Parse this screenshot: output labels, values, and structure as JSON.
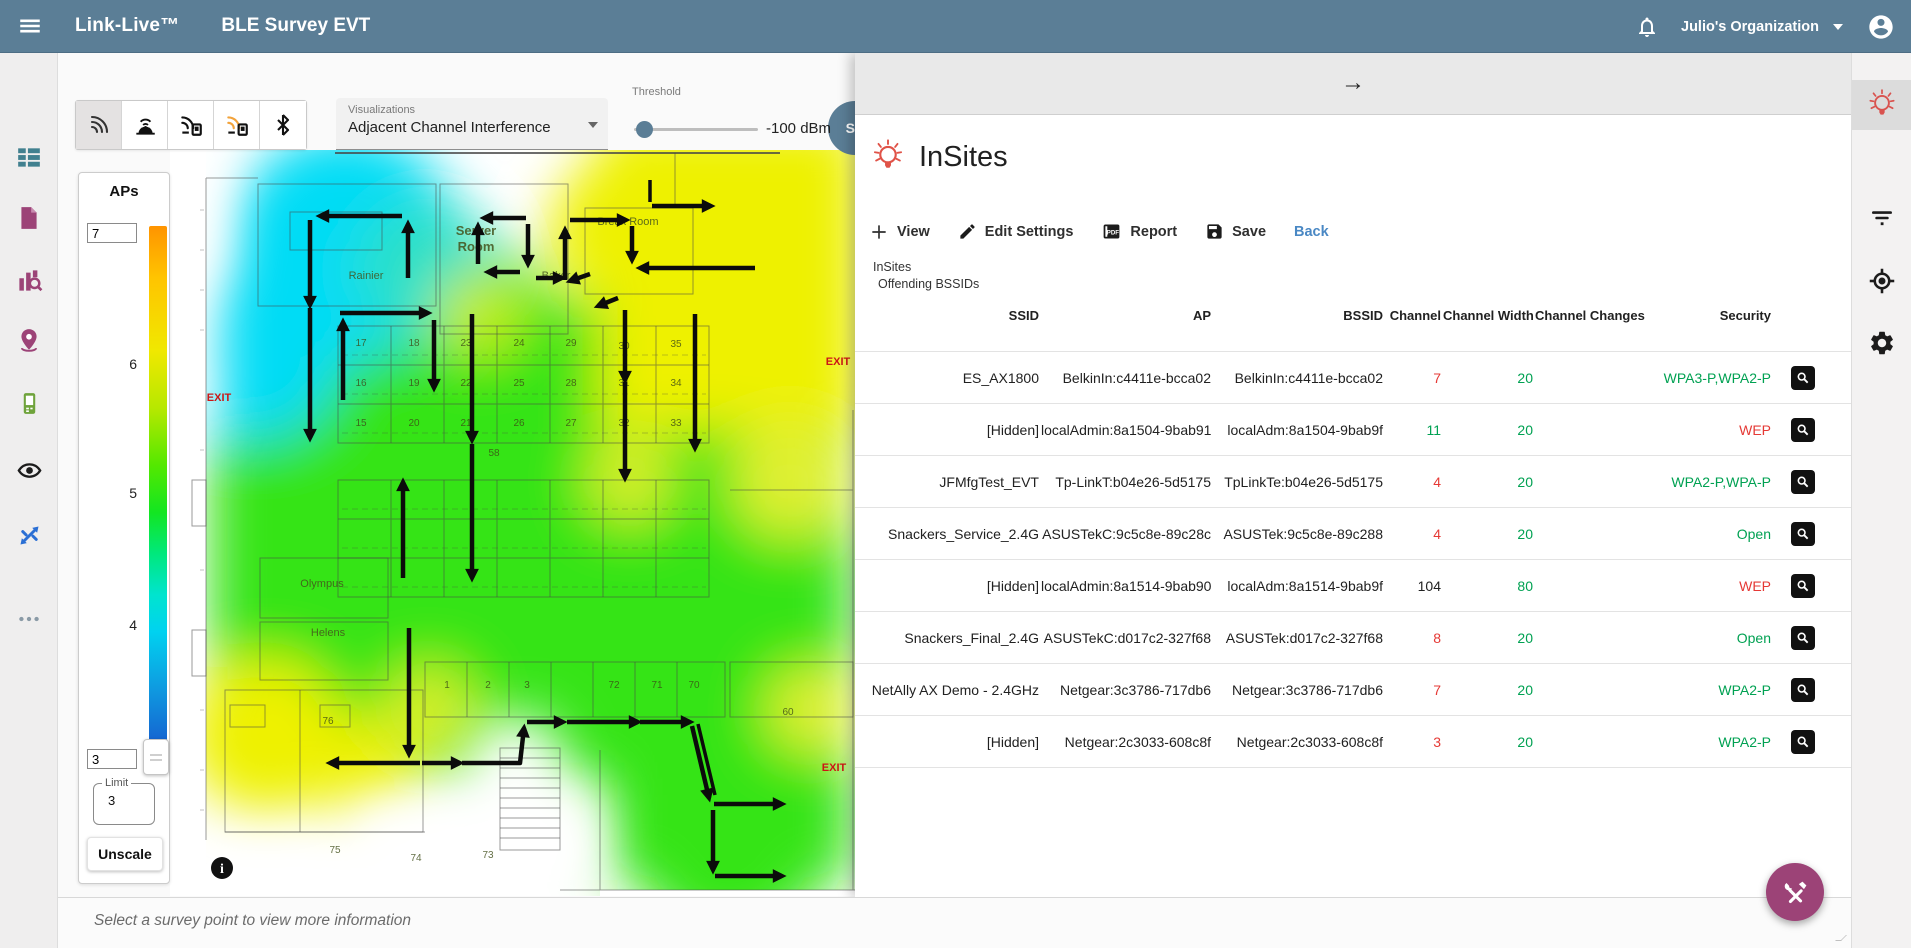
{
  "topbar": {
    "brand": "Link-Live™",
    "app_title": "BLE Survey EVT",
    "organization": "Julio's Organization",
    "icons": [
      "menu-icon",
      "notifications-bell-icon",
      "caret-down-icon",
      "account-circle-icon"
    ]
  },
  "left_rail": {
    "icons": [
      "dashboard-list-icon",
      "document-icon",
      "analysis-icon",
      "sites-pin-icon",
      "tester-device-icon",
      "discovery-eye-icon",
      "autotest-arrows-icon",
      "more-dots-icon"
    ]
  },
  "right_rail": {
    "icons": [
      "insites-bulb-icon",
      "filter-icon",
      "locate-icon",
      "settings-gear-icon"
    ],
    "active": "insites-bulb-icon"
  },
  "toolbar": {
    "mode_buttons": [
      "signal-icon",
      "access-point-icon",
      "signal-device-icon",
      "interference-device-icon",
      "bluetooth-icon"
    ],
    "selected_mode": "signal-icon",
    "visualizations_label": "Visualizations",
    "visualization_value": "Adjacent Channel Interference",
    "threshold_label": "Threshold",
    "threshold_value": "-100 dBm",
    "ssid_badge": "SS"
  },
  "aps_panel": {
    "title": "APs",
    "max_value": "7",
    "scale_labels": [
      "6",
      "5",
      "4"
    ],
    "min_value": "3",
    "limit_label": "Limit",
    "limit_value": "3",
    "unscale_button": "Unscale"
  },
  "map": {
    "labels": [
      {
        "text": "Server",
        "x": 306,
        "y": 85,
        "cls": "room"
      },
      {
        "text": "Room",
        "x": 306,
        "y": 101,
        "cls": "room"
      },
      {
        "text": "Rainier",
        "x": 196,
        "y": 129,
        "cls": "room-sm"
      },
      {
        "text": "Baker",
        "x": 386,
        "y": 129,
        "cls": "room-sm"
      },
      {
        "text": "Break Room",
        "x": 458,
        "y": 75,
        "cls": "room-sm"
      },
      {
        "text": "Olympus",
        "x": 152,
        "y": 437,
        "cls": "room-sm"
      },
      {
        "text": "Helens",
        "x": 158,
        "y": 486,
        "cls": "room-sm"
      },
      {
        "text": "EXIT",
        "x": 49,
        "y": 251,
        "cls": "exit"
      },
      {
        "text": "EXIT",
        "x": 668,
        "y": 215,
        "cls": "exit"
      },
      {
        "text": "EXIT",
        "x": 664,
        "y": 621,
        "cls": "exit"
      },
      {
        "text": "17",
        "x": 191,
        "y": 196,
        "cls": "num"
      },
      {
        "text": "18",
        "x": 244,
        "y": 196,
        "cls": "num"
      },
      {
        "text": "23",
        "x": 296,
        "y": 196,
        "cls": "num"
      },
      {
        "text": "24",
        "x": 349,
        "y": 196,
        "cls": "num"
      },
      {
        "text": "29",
        "x": 401,
        "y": 196,
        "cls": "num"
      },
      {
        "text": "30",
        "x": 454,
        "y": 199,
        "cls": "num"
      },
      {
        "text": "35",
        "x": 506,
        "y": 197,
        "cls": "num"
      },
      {
        "text": "16",
        "x": 191,
        "y": 236,
        "cls": "num"
      },
      {
        "text": "19",
        "x": 244,
        "y": 236,
        "cls": "num"
      },
      {
        "text": "22",
        "x": 296,
        "y": 236,
        "cls": "num"
      },
      {
        "text": "25",
        "x": 349,
        "y": 236,
        "cls": "num"
      },
      {
        "text": "28",
        "x": 401,
        "y": 236,
        "cls": "num"
      },
      {
        "text": "31",
        "x": 454,
        "y": 236,
        "cls": "num"
      },
      {
        "text": "34",
        "x": 506,
        "y": 236,
        "cls": "num"
      },
      {
        "text": "15",
        "x": 191,
        "y": 276,
        "cls": "num"
      },
      {
        "text": "20",
        "x": 244,
        "y": 276,
        "cls": "num"
      },
      {
        "text": "21",
        "x": 296,
        "y": 276,
        "cls": "num"
      },
      {
        "text": "26",
        "x": 349,
        "y": 276,
        "cls": "num"
      },
      {
        "text": "27",
        "x": 401,
        "y": 276,
        "cls": "num"
      },
      {
        "text": "32",
        "x": 454,
        "y": 276,
        "cls": "num"
      },
      {
        "text": "33",
        "x": 506,
        "y": 276,
        "cls": "num"
      },
      {
        "text": "58",
        "x": 324,
        "y": 306,
        "cls": "num"
      },
      {
        "text": "76",
        "x": 158,
        "y": 574,
        "cls": "num"
      },
      {
        "text": "75",
        "x": 165,
        "y": 703,
        "cls": "num"
      },
      {
        "text": "74",
        "x": 246,
        "y": 711,
        "cls": "num"
      },
      {
        "text": "73",
        "x": 318,
        "y": 708,
        "cls": "num"
      },
      {
        "text": "1",
        "x": 277,
        "y": 538,
        "cls": "num"
      },
      {
        "text": "2",
        "x": 318,
        "y": 538,
        "cls": "num"
      },
      {
        "text": "3",
        "x": 357,
        "y": 538,
        "cls": "num"
      },
      {
        "text": "72",
        "x": 444,
        "y": 538,
        "cls": "num"
      },
      {
        "text": "71",
        "x": 487,
        "y": 538,
        "cls": "num"
      },
      {
        "text": "70",
        "x": 524,
        "y": 538,
        "cls": "num"
      },
      {
        "text": "60",
        "x": 618,
        "y": 565,
        "cls": "num"
      }
    ],
    "info_icon": "i"
  },
  "insites": {
    "collapse_arrow": "→",
    "title": "InSites",
    "actions": [
      {
        "icon": "plus-icon",
        "label": "View"
      },
      {
        "icon": "pencil-icon",
        "label": "Edit Settings"
      },
      {
        "icon": "pdf-report-icon",
        "label": "Report"
      },
      {
        "icon": "save-icon",
        "label": "Save"
      }
    ],
    "back_label": "Back",
    "breadcrumb": [
      "InSites",
      "Offending BSSIDs"
    ],
    "table": {
      "columns": [
        "SSID",
        "AP",
        "BSSID",
        "Channel",
        "Channel Width",
        "Channel Changes",
        "Security"
      ],
      "rows": [
        {
          "ssid": "ES_AX1800",
          "ap": "BelkinIn:c4411e-bcca02",
          "bssid": "BelkinIn:c4411e-bcca02",
          "channel": "7",
          "channel_color": "t-red",
          "channel_width": "20",
          "width_color": "t-green",
          "channel_changes": "",
          "security": "WPA3-P,WPA2-P",
          "security_color": "t-green"
        },
        {
          "ssid": "[Hidden]",
          "ap": "localAdmin:8a1504-9bab91",
          "bssid": "localAdm:8a1504-9bab9f",
          "channel": "11",
          "channel_color": "t-green",
          "channel_width": "20",
          "width_color": "t-green",
          "channel_changes": "",
          "security": "WEP",
          "security_color": "t-red"
        },
        {
          "ssid": "JFMfgTest_EVT",
          "ap": "Tp-LinkT:b04e26-5d5175",
          "bssid": "TpLinkTe:b04e26-5d5175",
          "channel": "4",
          "channel_color": "t-red",
          "channel_width": "20",
          "width_color": "t-green",
          "channel_changes": "",
          "security": "WPA2-P,WPA-P",
          "security_color": "t-green"
        },
        {
          "ssid": "Snackers_Service_2.4G",
          "ap": "ASUSTekC:9c5c8e-89c28c",
          "bssid": "ASUSTek:9c5c8e-89c288",
          "channel": "4",
          "channel_color": "t-red",
          "channel_width": "20",
          "width_color": "t-green",
          "channel_changes": "",
          "security": "Open",
          "security_color": "t-green"
        },
        {
          "ssid": "[Hidden]",
          "ap": "localAdmin:8a1514-9bab90",
          "bssid": "localAdm:8a1514-9bab9f",
          "channel": "104",
          "channel_color": "t-black",
          "channel_width": "80",
          "width_color": "t-green",
          "channel_changes": "",
          "security": "WEP",
          "security_color": "t-red"
        },
        {
          "ssid": "Snackers_Final_2.4G",
          "ap": "ASUSTekC:d017c2-327f68",
          "bssid": "ASUSTek:d017c2-327f68",
          "channel": "8",
          "channel_color": "t-red",
          "channel_width": "20",
          "width_color": "t-green",
          "channel_changes": "",
          "security": "Open",
          "security_color": "t-green"
        },
        {
          "ssid": "NetAlly AX Demo - 2.4GHz",
          "ap": "Netgear:3c3786-717db6",
          "bssid": "Netgear:3c3786-717db6",
          "channel": "7",
          "channel_color": "t-red",
          "channel_width": "20",
          "width_color": "t-green",
          "channel_changes": "",
          "security": "WPA2-P",
          "security_color": "t-green"
        },
        {
          "ssid": "[Hidden]",
          "ap": "Netgear:2c3033-608c8f",
          "bssid": "Netgear:2c3033-608c8f",
          "channel": "3",
          "channel_color": "t-red",
          "channel_width": "20",
          "width_color": "t-green",
          "channel_changes": "",
          "security": "WPA2-P",
          "security_color": "t-green"
        }
      ]
    }
  },
  "status_bar": {
    "message": "Select a survey point to view more information"
  },
  "fab": {
    "icon": "tools-icon"
  },
  "colors": {
    "topbar": "#5b7e96",
    "accent_purple": "#9c4377",
    "ok_green": "#00a152",
    "alert_red": "#e53935",
    "link_blue": "#4a88c4",
    "heat_cyan": "#00dcf5",
    "heat_green": "#35e414",
    "heat_yellow": "#eef104"
  }
}
